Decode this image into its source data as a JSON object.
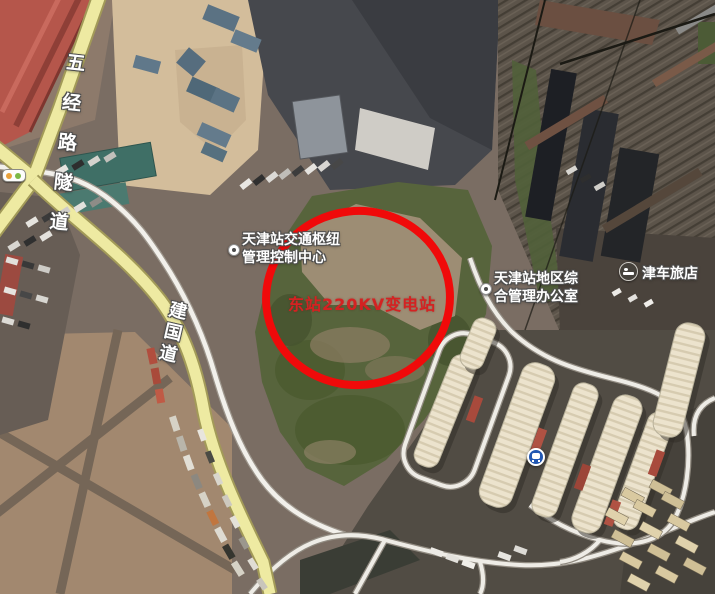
{
  "map": {
    "labels": {
      "road_tunnel": "五经路隧道",
      "road_jianguo": "建国道",
      "poi_hub": {
        "line1": "天津站交通枢纽",
        "line2": "管理控制中心"
      },
      "poi_office": {
        "line1": "天津站地区综",
        "line2": "合管理办公室"
      },
      "poi_hotel": "津车旅店",
      "annotation": "东站220KV变电站"
    },
    "icons": {
      "hotel": "hotel-bed-icon",
      "bus_station": "bus-station-icon",
      "traffic_light": "traffic-light-icon",
      "poi_marker": "poi-dot-icon"
    },
    "colors": {
      "annotation_circle": "#f00a0a",
      "annotation_text": "#d42222",
      "road_yellow": "#eeeaa2",
      "road_white": "#f2f0eb",
      "bus_icon_blue": "#2257b2",
      "label_text": "#ffffff",
      "vegetation_green": "#57643c",
      "dirt_brown": "#9d8d74"
    }
  }
}
